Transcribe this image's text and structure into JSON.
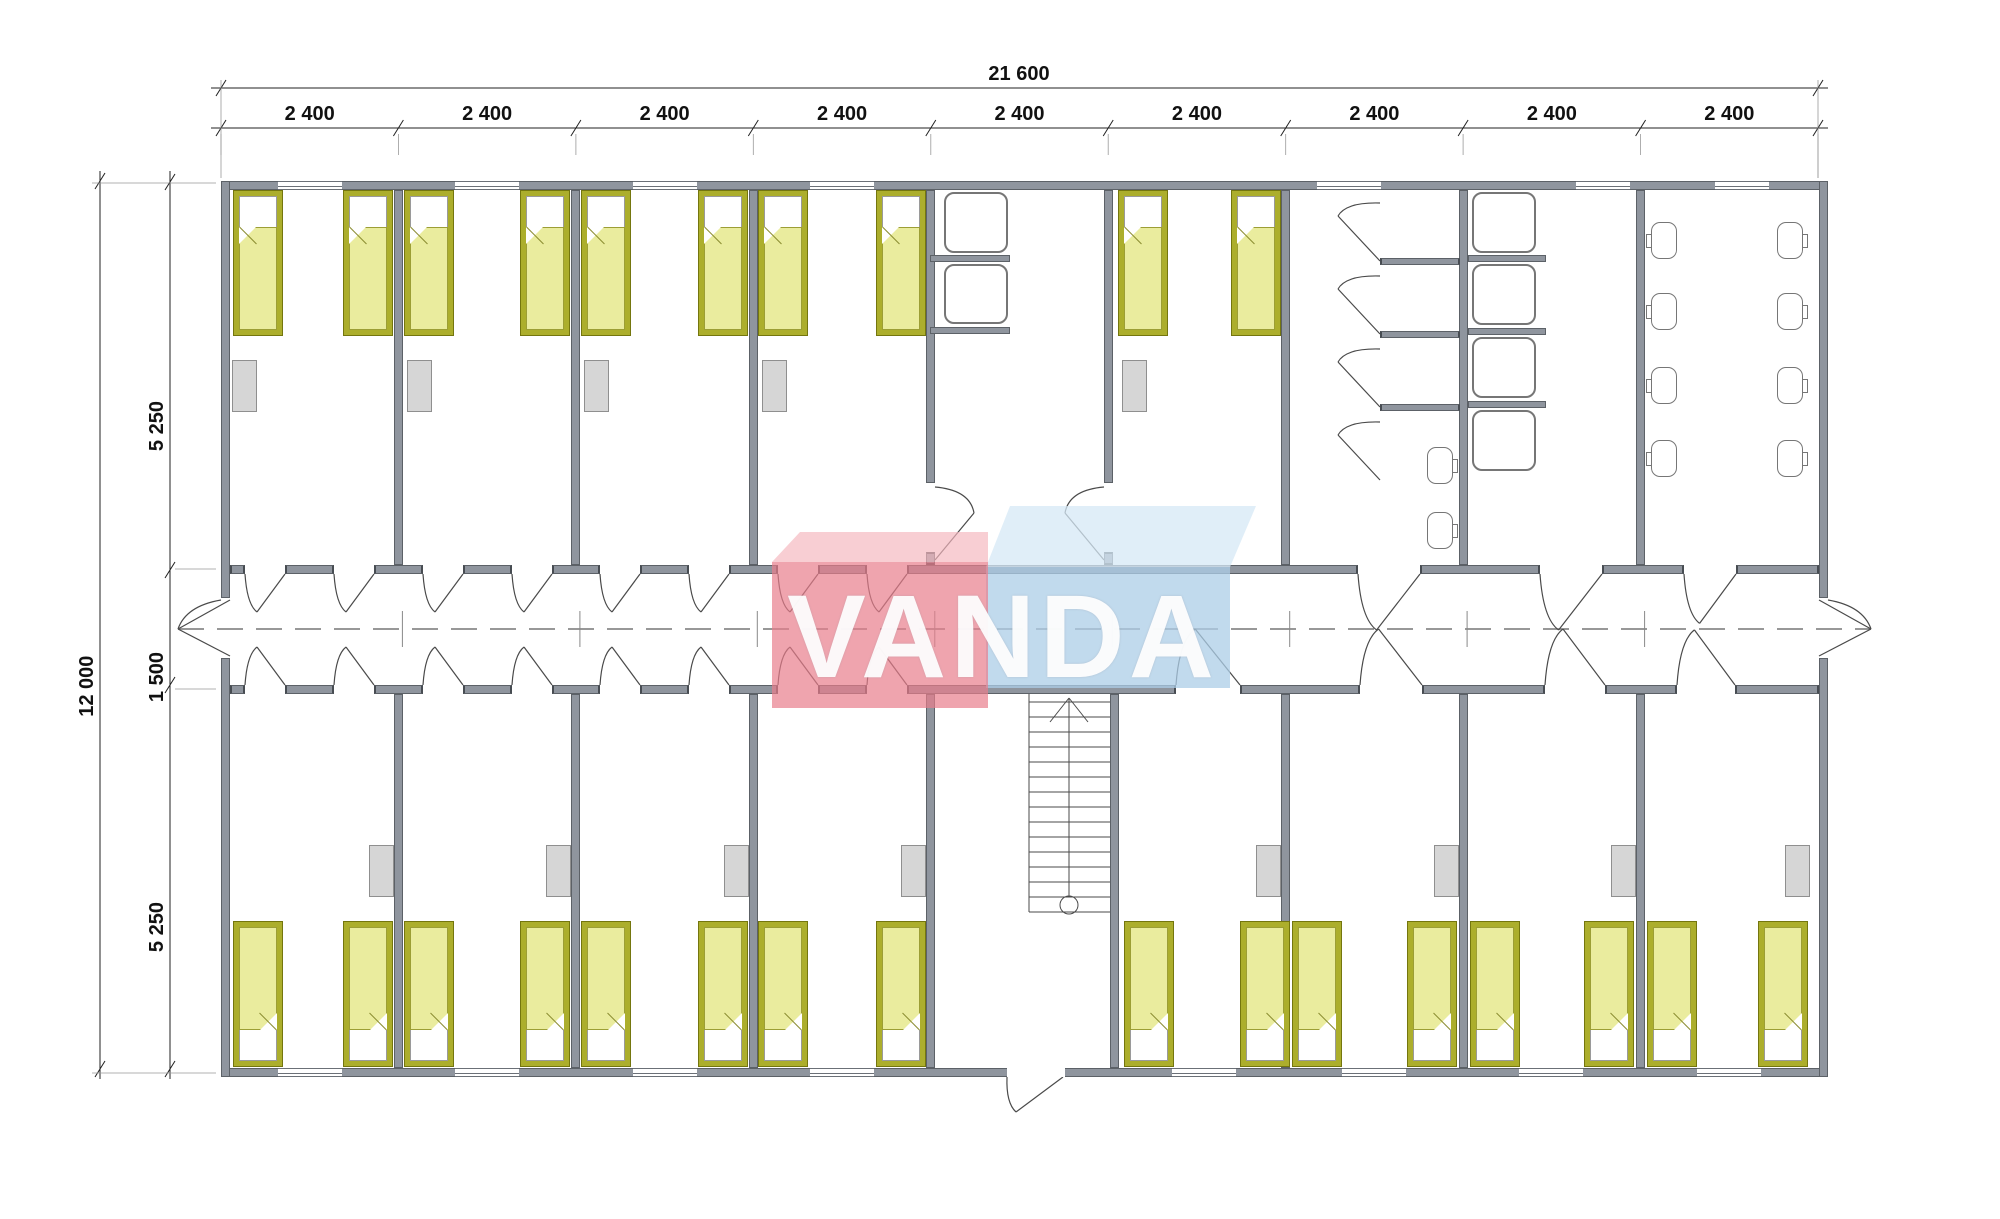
{
  "dims": {
    "total_width_label": "21 600",
    "total_height_label": "12 000",
    "module_labels": [
      "2 400",
      "2 400",
      "2 400",
      "2 400",
      "2 400",
      "2 400",
      "2 400",
      "2 400",
      "2 400"
    ],
    "left_segment_labels": [
      "5 250",
      "1 500",
      "5 250"
    ]
  },
  "logo": {
    "text": "VANDA",
    "red_front": "rgba(232,126,139,0.70)",
    "red_top": "rgba(244,183,190,0.68)",
    "blue_front": "rgba(172,205,231,0.75)",
    "blue_top": "rgba(213,232,245,0.75)"
  },
  "colors": {
    "wall_fill": "#8F959E",
    "wall_edge": "#5C6167",
    "bed_frame": "#ACAE2C",
    "bed_blanket": "#EAEC9E",
    "wardrobe": "#D6D6D6",
    "line": "#4a4a4a",
    "dim_line": "#222222"
  },
  "geometry": {
    "building": {
      "left": 221,
      "right": 1828,
      "top": 181,
      "bottom": 1077,
      "wall": 9
    },
    "corridor": {
      "top_wall_y": 565,
      "bottom_wall_y": 685,
      "wall": 9,
      "center_y": 629,
      "left_exit_point": [
        178,
        629
      ],
      "right_exit_point": [
        1871,
        629
      ],
      "exit_gap_y": [
        598,
        658
      ]
    },
    "module_boundaries": [
      221,
      398.4,
      575.9,
      753.3,
      930.8,
      1108.2,
      1285.7,
      1463.1,
      1640.6,
      1818
    ],
    "dim_lines": {
      "total_y": 88,
      "module_y": 128,
      "label_total_y": 63,
      "label_module_y": 103,
      "outer_x": 100,
      "inner_x": 170,
      "left_ticks_y": [
        182,
        570,
        685,
        1069
      ],
      "left_label_x_outer": 76,
      "left_label_x_inner": 146,
      "left_label_centers_y": [
        376,
        627,
        877
      ],
      "total_label_center_x": 1019,
      "height_label_center_y": 625
    },
    "corridor_top_segments": [
      [
        230,
        245
      ],
      [
        285,
        334
      ],
      [
        374,
        423
      ],
      [
        463,
        512
      ],
      [
        552,
        600
      ],
      [
        640,
        689
      ],
      [
        729,
        778
      ],
      [
        818,
        867
      ],
      [
        907,
        1358
      ],
      [
        1420,
        1540
      ],
      [
        1602,
        1684
      ],
      [
        1736,
        1819
      ]
    ],
    "corridor_bottom_segments": [
      [
        230,
        245
      ],
      [
        285,
        334
      ],
      [
        374,
        423
      ],
      [
        463,
        512
      ],
      [
        552,
        600
      ],
      [
        640,
        689
      ],
      [
        729,
        778
      ],
      [
        818,
        867
      ],
      [
        907,
        1176
      ],
      [
        1240,
        1360
      ],
      [
        1422,
        1545
      ],
      [
        1605,
        1677
      ],
      [
        1735,
        1819
      ]
    ],
    "doors_top": [
      [
        245,
        285
      ],
      [
        334,
        374
      ],
      [
        423,
        463
      ],
      [
        512,
        552
      ],
      [
        600,
        640
      ],
      [
        689,
        729
      ],
      [
        778,
        818
      ],
      [
        867,
        907
      ],
      [
        1358,
        1420
      ],
      [
        1540,
        1602
      ],
      [
        1684,
        1736
      ]
    ],
    "doors_bottom": [
      [
        245,
        285
      ],
      [
        334,
        374
      ],
      [
        423,
        463
      ],
      [
        512,
        552
      ],
      [
        600,
        640
      ],
      [
        689,
        729
      ],
      [
        778,
        818
      ],
      [
        867,
        907
      ],
      [
        1176,
        1240
      ],
      [
        1360,
        1422
      ],
      [
        1545,
        1605
      ],
      [
        1677,
        1735
      ]
    ],
    "partitions_top_full": [
      394,
      571,
      749,
      1281,
      1459,
      1636
    ],
    "partitions_top_door": [
      926,
      1104
    ],
    "partitions_bottom": [
      394,
      571,
      749,
      926,
      1110,
      1281,
      1459,
      1636
    ],
    "partition_stub_y": [
      552,
      565
    ],
    "windows_top": [
      [
        278,
        342
      ],
      [
        455,
        519
      ],
      [
        633,
        697
      ],
      [
        810,
        874
      ],
      [
        1317,
        1381
      ],
      [
        1576,
        1630
      ],
      [
        1715,
        1769
      ]
    ],
    "windows_bottom": [
      [
        278,
        342
      ],
      [
        455,
        519
      ],
      [
        633,
        697
      ],
      [
        810,
        874
      ],
      [
        1172,
        1236
      ],
      [
        1342,
        1406
      ],
      [
        1519,
        1583
      ],
      [
        1697,
        1761
      ]
    ],
    "entrance_gap": [
      1007,
      1065
    ],
    "beds_top_x": [
      233,
      343,
      404,
      520,
      581,
      698,
      758,
      876,
      1118,
      1231
    ],
    "beds_bottom_x": [
      233,
      343,
      404,
      520,
      581,
      698,
      758,
      876,
      1124,
      1240,
      1292,
      1407,
      1470,
      1584,
      1647,
      1758
    ],
    "bed": {
      "w": 50,
      "h": 146,
      "top_y": 190,
      "bottom_y": 921
    },
    "wardrobes_top_x": [
      232,
      407,
      584,
      762,
      1122
    ],
    "wardrobes_bottom_x": [
      369,
      546,
      724,
      901,
      1256,
      1434,
      1611,
      1785
    ],
    "wardrobe_y": {
      "top": 360,
      "bottom": 845
    },
    "sinks": [
      [
        944,
        192,
        64,
        61
      ],
      [
        944,
        264,
        64,
        60
      ]
    ],
    "sink_stubs": [
      [
        930,
        255,
        80,
        7
      ],
      [
        930,
        327,
        80,
        7
      ]
    ],
    "shower_trays": [
      [
        1472,
        192,
        64,
        61
      ],
      [
        1472,
        264,
        64,
        61
      ],
      [
        1472,
        337,
        64,
        61
      ],
      [
        1472,
        410,
        64,
        61
      ]
    ],
    "shower_stubs": [
      [
        1468,
        255,
        78,
        7
      ],
      [
        1468,
        328,
        78,
        7
      ],
      [
        1468,
        401,
        78,
        7
      ]
    ],
    "cubicle_dividers": [
      [
        1380,
        258,
        80,
        7
      ],
      [
        1380,
        331,
        80,
        7
      ],
      [
        1380,
        404,
        80,
        7
      ]
    ],
    "cubicle_door_y": [
      258,
      331,
      404,
      477
    ],
    "toilets": [
      {
        "x": 1427,
        "y": 447,
        "tank": "right"
      },
      {
        "x": 1427,
        "y": 512,
        "tank": "right"
      },
      {
        "x": 1651,
        "y": 222,
        "tank": "left"
      },
      {
        "x": 1651,
        "y": 293,
        "tank": "left"
      },
      {
        "x": 1651,
        "y": 367,
        "tank": "left"
      },
      {
        "x": 1651,
        "y": 440,
        "tank": "left"
      },
      {
        "x": 1777,
        "y": 222,
        "tank": "right"
      },
      {
        "x": 1777,
        "y": 293,
        "tank": "right"
      },
      {
        "x": 1777,
        "y": 367,
        "tank": "right"
      },
      {
        "x": 1777,
        "y": 440,
        "tank": "right"
      }
    ],
    "toilet": {
      "bowl_w": 26,
      "bowl_h": 37,
      "tank_w": 6,
      "tank_h": 14
    },
    "stairs": {
      "x1": 1029,
      "x2": 1110,
      "y1": 694,
      "y2": 912,
      "treads": 15,
      "center_x": 1069,
      "circle_y": 905,
      "circle_r": 9
    },
    "logo_shapes": {
      "blue_top": [
        [
          1010,
          506
        ],
        [
          1256,
          506
        ],
        [
          1230,
          567
        ],
        [
          986,
          567
        ]
      ],
      "blue_front": [
        [
          986,
          567
        ],
        [
          1230,
          567
        ],
        [
          1230,
          688
        ],
        [
          986,
          688
        ]
      ],
      "red_top": [
        [
          800,
          532
        ],
        [
          988,
          532
        ],
        [
          988,
          562
        ],
        [
          772,
          562
        ]
      ],
      "red_front": [
        [
          772,
          562
        ],
        [
          988,
          562
        ],
        [
          988,
          708
        ],
        [
          772,
          708
        ]
      ]
    }
  }
}
